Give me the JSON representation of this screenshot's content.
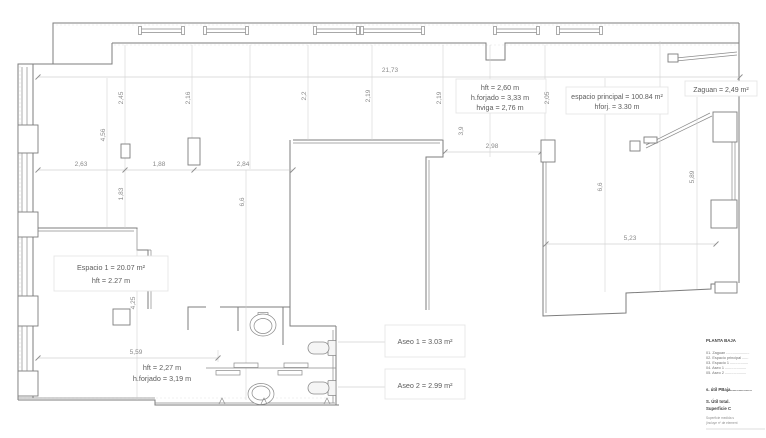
{
  "dims": {
    "total_width": "21,73",
    "w_263": "2,63",
    "w_188": "1,88",
    "w_284": "2,84",
    "w_298": "2,98",
    "w_559": "5,59",
    "w_523": "5,23",
    "b_245": "2,45",
    "b_216": "2,16",
    "b_22": "2,2",
    "b_219a": "2,19",
    "b_219b": "2,19",
    "b_205": "2,05",
    "d_456": "4,56",
    "d_183": "1,83",
    "d_66a": "6,6",
    "d_39": "3,9",
    "d_66b": "6,6",
    "d_589": "5,89",
    "d_425": "4,25"
  },
  "rooms": {
    "espacio_principal": [
      "espacio principal = 100.84 m²",
      "hforj. = 3.30 m"
    ],
    "main_heights": [
      "hft = 2,60 m",
      "h.forjado = 3,33 m",
      "hviga = 2,76 m"
    ],
    "zaguan": "Zaguan = 2,49 m²",
    "espacio1": [
      "Espacio 1 = 20.07 m²",
      "hft = 2.27 m"
    ],
    "espacio1_heights": [
      "hft = 2,27 m",
      "h.forjado = 3,19 m"
    ],
    "aseo1": "Aseo 1 = 3.03 m²",
    "aseo2": "Aseo 2 = 2.99 m²"
  },
  "legend": {
    "title": "PLANTA BAJA",
    "items": [
      "01. Zaguan ......................",
      "02. Espacio principal ......",
      "03. Espacio 1 .................",
      "04. Aseo 1 ....................",
      "05. Aseo 2 ...................."
    ],
    "subtotal": "s. útil PBaja..................",
    "total": "S. Útil total.",
    "total2": "Superficie C",
    "note1": "Superficie medida s",
    "note2": "(incluye nº de element"
  }
}
